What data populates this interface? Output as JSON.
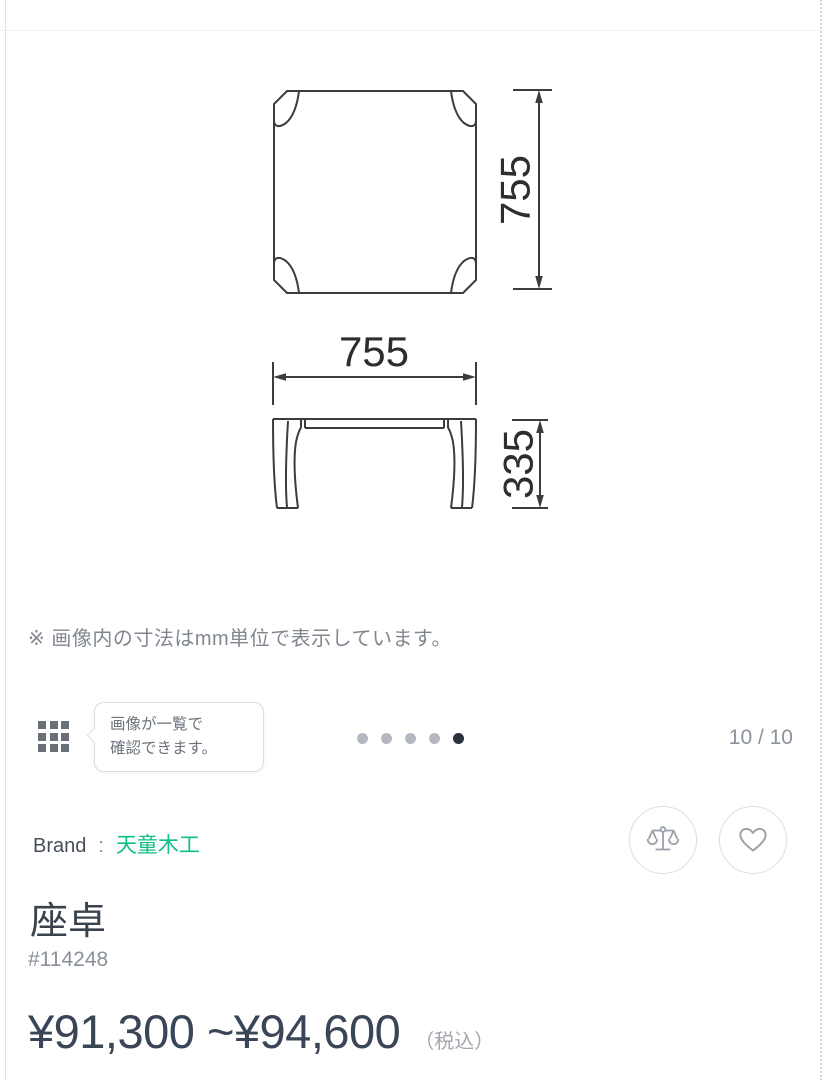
{
  "drawing": {
    "top_view_height_label": "755",
    "front_view_width_label": "755",
    "front_view_height_label": "335",
    "line_color": "#3c3c3c"
  },
  "note": "※ 画像内の寸法はmm単位で表示しています。",
  "gallery": {
    "grid_icon": "thumbnail-grid-icon",
    "tooltip_line1": "画像が一覧で",
    "tooltip_line2": "確認できます。",
    "page_indicator": "10 / 10",
    "dots_total": 5,
    "active_dot_index": 4,
    "dot_color_inactive": "#b4b7c2",
    "dot_color_active": "#28313e"
  },
  "product": {
    "brand_label": "Brand",
    "brand_separator": ":",
    "brand_name": "天童木工",
    "brand_color": "#0fbf8a",
    "title": "座卓",
    "sku": "#114248",
    "price_range": "¥91,300 ~¥94,600",
    "tax_note": "（税込）"
  },
  "actions": {
    "compare_icon": "balance-scale-icon",
    "favorite_icon": "heart-icon"
  }
}
